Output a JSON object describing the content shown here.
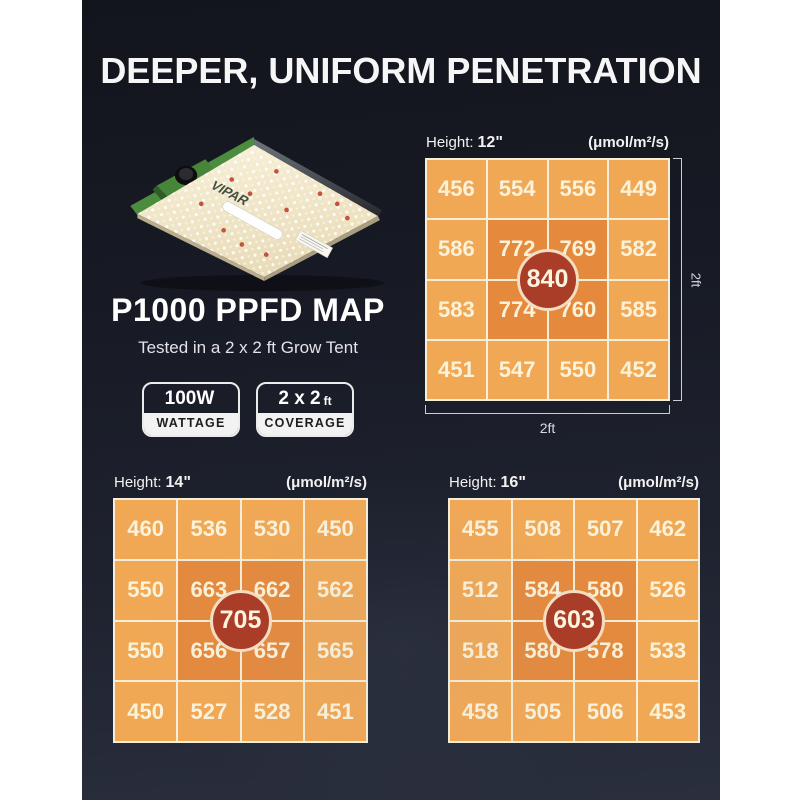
{
  "title": "DEEPER, UNIFORM PENETRATION",
  "product": {
    "name": "P1000 PPFD MAP",
    "subtitle": "Tested in a 2 x 2 ft Grow Tent",
    "brand": "VIPAR",
    "badges": [
      {
        "value": "100W",
        "unit": "",
        "label": "WATTAGE"
      },
      {
        "value": "2 x 2",
        "unit": "ft",
        "label": "COVERAGE"
      }
    ]
  },
  "colors": {
    "panel_bg": "#1a1d27",
    "cell_orange": "#f1a855",
    "cell_hot_orange": "#e58a3d",
    "center_red": "#a93d28",
    "grid_line_cream": "#f5eeda",
    "cell_text_cream": "#fbf2da",
    "fixture_green": "#4c8c3e",
    "fixture_board": "#f3ebd2"
  },
  "chart_data": [
    {
      "type": "heatmap",
      "height_label": "Height:",
      "height_value": "12\"",
      "units": "(μmol/m²/s)",
      "rows": [
        [
          456,
          554,
          556,
          449
        ],
        [
          586,
          772,
          769,
          582
        ],
        [
          583,
          774,
          760,
          585
        ],
        [
          451,
          547,
          550,
          452
        ]
      ],
      "center_value": 840,
      "width_dim": "2ft",
      "height_dim": "2ft"
    },
    {
      "type": "heatmap",
      "height_label": "Height:",
      "height_value": "14\"",
      "units": "(μmol/m²/s)",
      "rows": [
        [
          460,
          536,
          530,
          450
        ],
        [
          550,
          663,
          662,
          562
        ],
        [
          550,
          656,
          657,
          565
        ],
        [
          450,
          527,
          528,
          451
        ]
      ],
      "center_value": 705
    },
    {
      "type": "heatmap",
      "height_label": "Height:",
      "height_value": "16\"",
      "units": "(μmol/m²/s)",
      "rows": [
        [
          455,
          508,
          507,
          462
        ],
        [
          512,
          584,
          580,
          526
        ],
        [
          518,
          580,
          578,
          533
        ],
        [
          458,
          505,
          506,
          453
        ]
      ],
      "center_value": 603
    }
  ]
}
